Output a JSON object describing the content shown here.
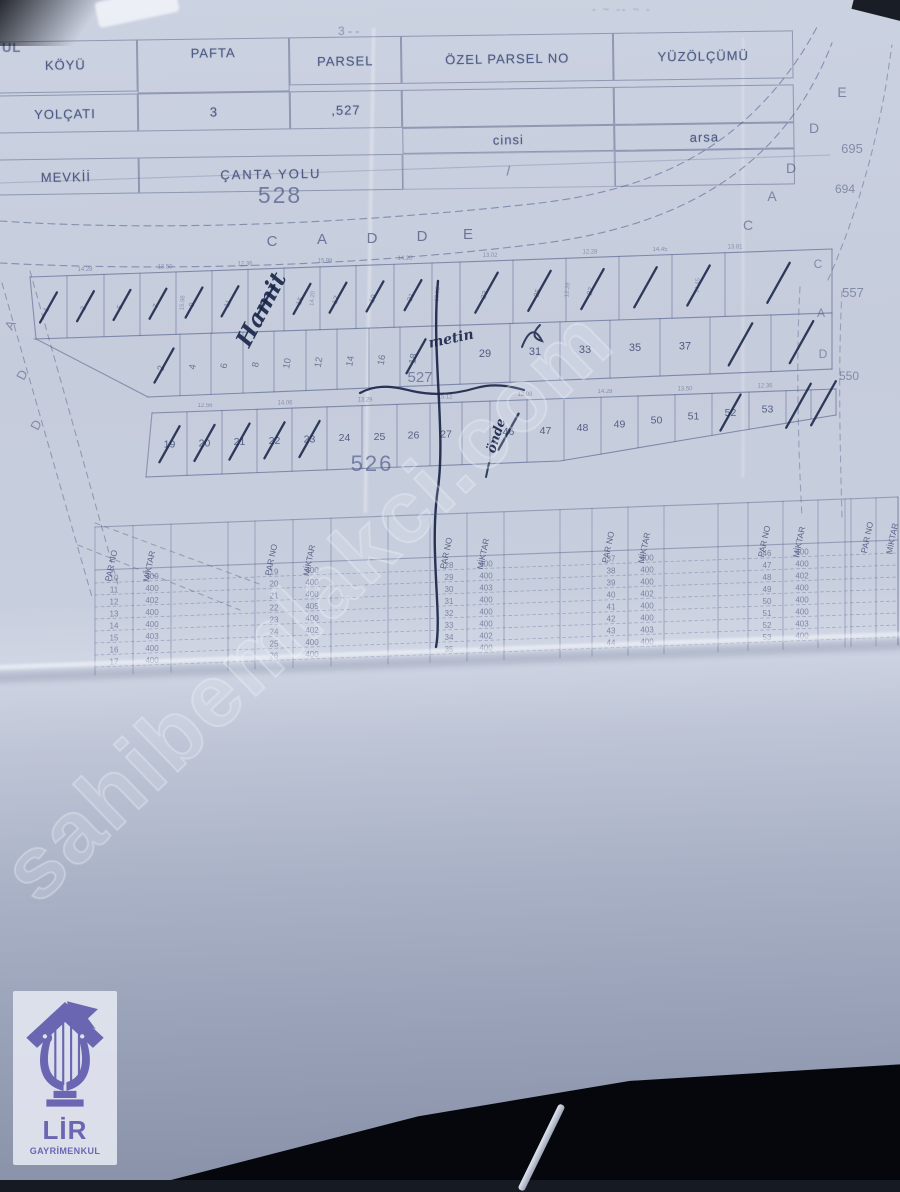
{
  "watermark": {
    "text": "sahibemlakci.com"
  },
  "logo": {
    "name_line1": "LİR",
    "name_line2": "GAYRİMENKUL"
  },
  "header_table": {
    "corner_fragment": "UL",
    "faint_mark_center": "3 - -",
    "faint_mark_right": "- ~ -- ~ -",
    "columns": [
      "KÖYÜ",
      "PAFTA",
      "PARSEL",
      "ÖZEL PARSEL  NO",
      "YÜZÖLÇÜMÜ"
    ],
    "village": "YOLÇATI",
    "pafta": "3",
    "parsel": ",527",
    "cinsi_label": "cinsi",
    "cinsi_value": "arsa",
    "mevkii_label": "MEVKİİ",
    "mevkii_value": "ÇANTA YOLU",
    "slash_cell": "/"
  },
  "map": {
    "block_labels": {
      "upper": "528",
      "middle": "527",
      "lower": "526"
    },
    "road_letters_top": [
      "C",
      "A",
      "D",
      "D",
      "E"
    ],
    "road_letters_right_diagonal": [
      "C",
      "A",
      "D",
      "D",
      "E"
    ],
    "road_letters_right_vertical": [
      "C",
      "A",
      "D"
    ],
    "road_letters_left": [
      "A",
      "D",
      "D"
    ],
    "adjacent_parcel_numbers": [
      "695",
      "694",
      "557",
      "550"
    ],
    "band1_top_numbers": [
      "1",
      "3",
      "5",
      "7",
      "9",
      "11",
      "13",
      "15",
      "17",
      "19",
      "21",
      "",
      "23",
      "25",
      "27",
      "",
      "",
      ""
    ],
    "band1_bottom_numbers": [
      "2",
      "4",
      "6",
      "8",
      "10",
      "12",
      "14",
      "16",
      "18",
      "",
      "29",
      "31",
      "33",
      "35",
      "37",
      "",
      ""
    ],
    "band2_numbers": [
      "19",
      "20",
      "21",
      "22",
      "23",
      "24",
      "25",
      "26",
      "27",
      "",
      "46",
      "47",
      "48",
      "49",
      "50",
      "51",
      "52",
      "53",
      "",
      ""
    ],
    "handwriting": {
      "h1": "Hamit",
      "h2": "metin",
      "h3": "önde"
    },
    "dimension_numbers": [
      "14.28",
      "13.50",
      "12.36",
      "15.98",
      "14.20",
      "13.02",
      "12.28",
      "14.45",
      "13.81",
      "12.56",
      "14.06",
      "13.29",
      "15.12",
      "12.98"
    ]
  },
  "area_table": {
    "header_par_no": "PAR NO",
    "header_miktar": "MİKTAR",
    "groups": [
      {
        "rows": [
          [
            "10",
            "400"
          ],
          [
            "11",
            "400"
          ],
          [
            "12",
            "402"
          ],
          [
            "13",
            "400"
          ],
          [
            "14",
            "400"
          ],
          [
            "15",
            "403"
          ],
          [
            "16",
            "400"
          ],
          [
            "17",
            "400"
          ]
        ]
      },
      {
        "rows": [
          [
            "19",
            "400"
          ],
          [
            "20",
            "400"
          ],
          [
            "21",
            "400"
          ],
          [
            "22",
            "405"
          ],
          [
            "23",
            "400"
          ],
          [
            "24",
            "402"
          ],
          [
            "25",
            "400"
          ],
          [
            "26",
            "400"
          ]
        ]
      },
      {
        "rows": [
          [
            "28",
            "400"
          ],
          [
            "29",
            "400"
          ],
          [
            "30",
            "403"
          ],
          [
            "31",
            "400"
          ],
          [
            "32",
            "400"
          ],
          [
            "33",
            "400"
          ],
          [
            "34",
            "402"
          ],
          [
            "35",
            "400"
          ]
        ]
      },
      {
        "rows": [
          [
            "37",
            "400"
          ],
          [
            "38",
            "400"
          ],
          [
            "39",
            "400"
          ],
          [
            "40",
            "402"
          ],
          [
            "41",
            "400"
          ],
          [
            "42",
            "400"
          ],
          [
            "43",
            "403"
          ],
          [
            "44",
            "400"
          ]
        ]
      },
      {
        "rows": [
          [
            "46",
            "400"
          ],
          [
            "47",
            "400"
          ],
          [
            "48",
            "402"
          ],
          [
            "49",
            "400"
          ],
          [
            "50",
            "400"
          ],
          [
            "51",
            "400"
          ],
          [
            "52",
            "403"
          ],
          [
            "53",
            "400"
          ]
        ]
      },
      {
        "rows": [
          [
            "",
            ""
          ],
          [
            "",
            ""
          ]
        ]
      }
    ]
  }
}
